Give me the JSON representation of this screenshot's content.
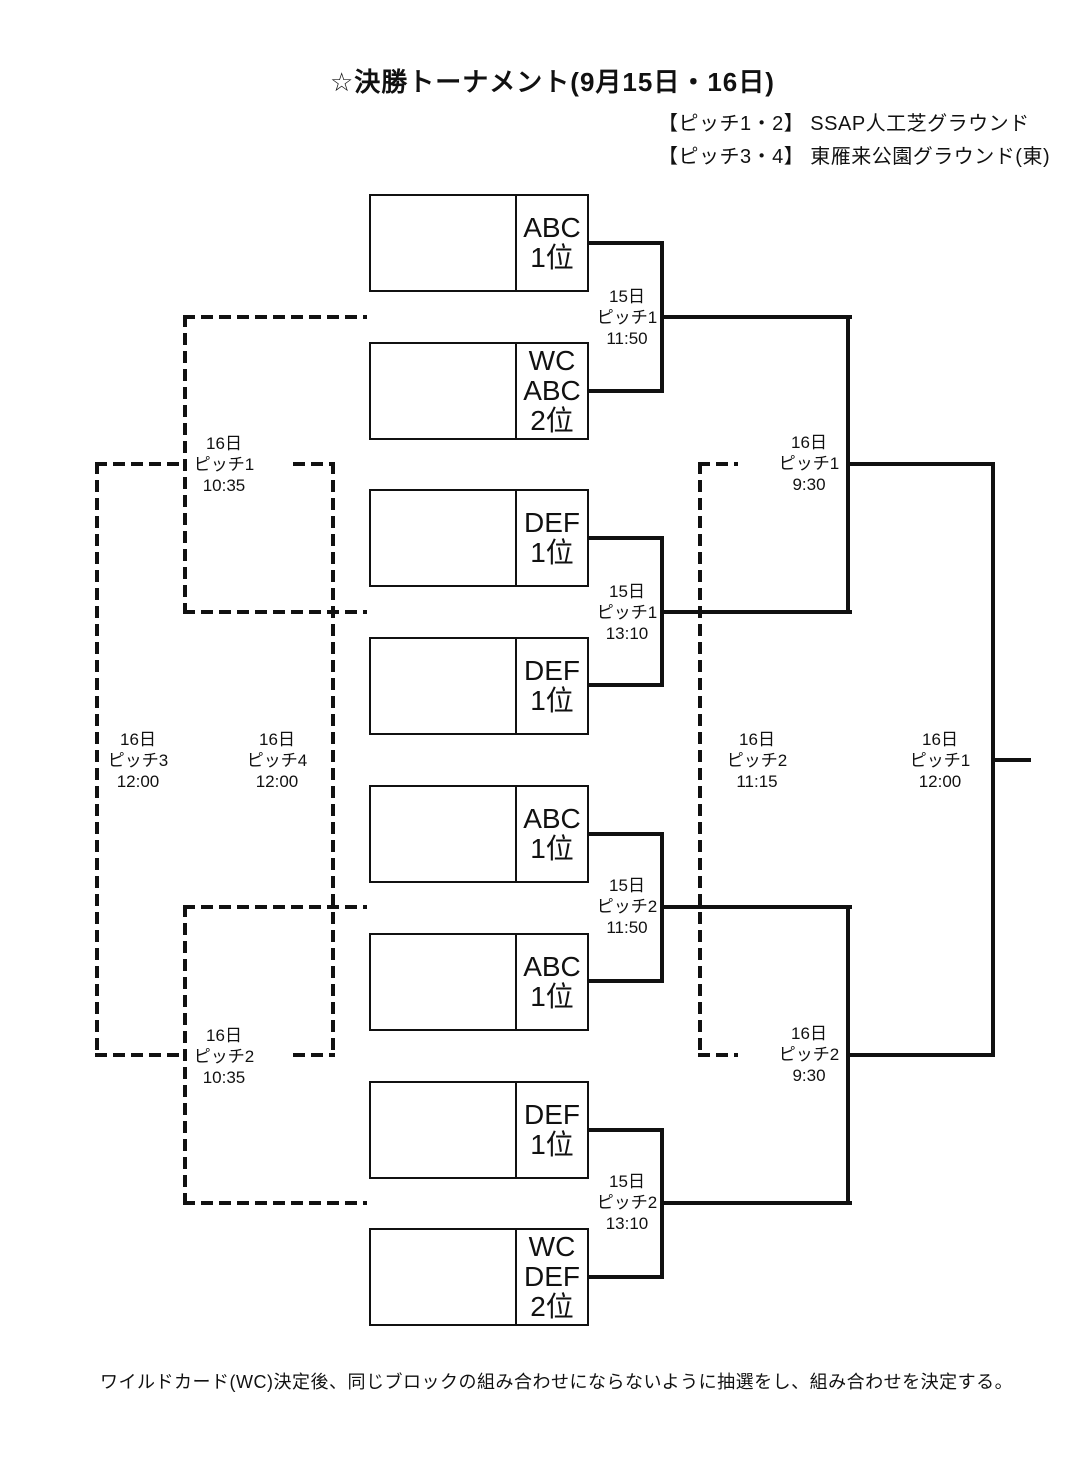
{
  "title": "☆決勝トーナメント(9月15日・16日)",
  "legend": {
    "line1": "【ピッチ1・2】 SSAP人工芝グラウンド",
    "line2": "【ピッチ3・4】 東雁来公園グラウンド(東)"
  },
  "slots": {
    "s1": [
      "ABC",
      "1位"
    ],
    "s2": [
      "WC",
      "ABC",
      "2位"
    ],
    "s3": [
      "DEF",
      "1位"
    ],
    "s4": [
      "DEF",
      "1位"
    ],
    "s5": [
      "ABC",
      "1位"
    ],
    "s6": [
      "ABC",
      "1位"
    ],
    "s7": [
      "DEF",
      "1位"
    ],
    "s8": [
      "WC",
      "DEF",
      "2位"
    ]
  },
  "matches": {
    "qf1": [
      "15日",
      "ピッチ1",
      "11:50"
    ],
    "qf2": [
      "15日",
      "ピッチ1",
      "13:10"
    ],
    "qf3": [
      "15日",
      "ピッチ2",
      "11:50"
    ],
    "qf4": [
      "15日",
      "ピッチ2",
      "13:10"
    ],
    "sf1": [
      "16日",
      "ピッチ1",
      "9:30"
    ],
    "sf2": [
      "16日",
      "ピッチ2",
      "9:30"
    ],
    "final": [
      "16日",
      "ピッチ1",
      "12:00"
    ],
    "third_place": [
      "16日",
      "ピッチ2",
      "11:15"
    ],
    "consolation_upper": [
      "16日",
      "ピッチ1",
      "10:35"
    ],
    "consolation_lower": [
      "16日",
      "ピッチ2",
      "10:35"
    ],
    "placement_pitch3": [
      "16日",
      "ピッチ3",
      "12:00"
    ],
    "placement_pitch4": [
      "16日",
      "ピッチ4",
      "12:00"
    ]
  },
  "note": "ワイルドカード(WC)決定後、同じブロックの組み合わせにならないように抽選をし、組み合わせを決定する。",
  "colors": {
    "line": "#111111",
    "text": "#111111",
    "background": "#ffffff"
  }
}
